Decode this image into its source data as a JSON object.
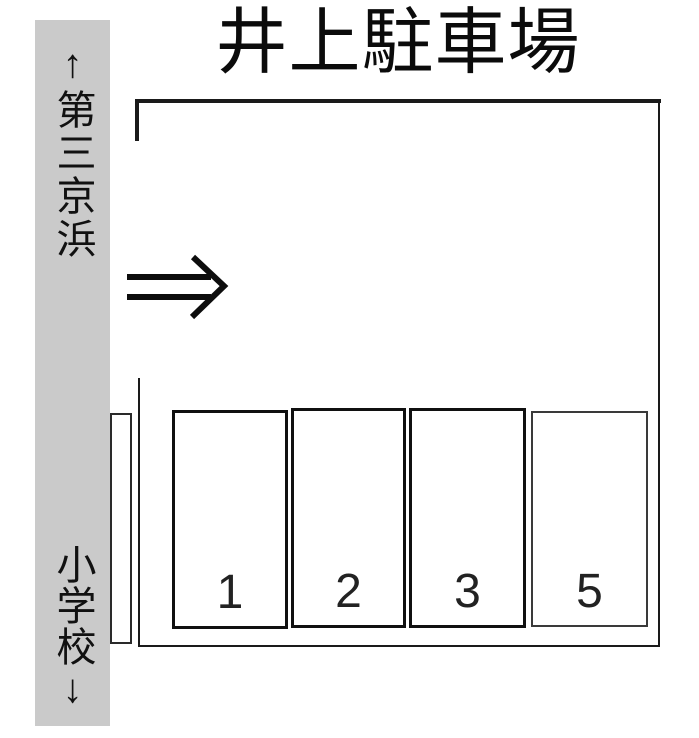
{
  "title": "井上駐車場",
  "road": {
    "top_label": "↑第三京浜",
    "bottom_label": "小学校↓"
  },
  "lot": {
    "entrance_arrow_icon": "double-right-arrow",
    "spaces": [
      {
        "label": "1"
      },
      {
        "label": "2"
      },
      {
        "label": "3"
      },
      {
        "label": "5"
      }
    ]
  },
  "colors": {
    "road_strip": "#cacaca",
    "outline": "#1a1a1a",
    "background": "#ffffff"
  }
}
